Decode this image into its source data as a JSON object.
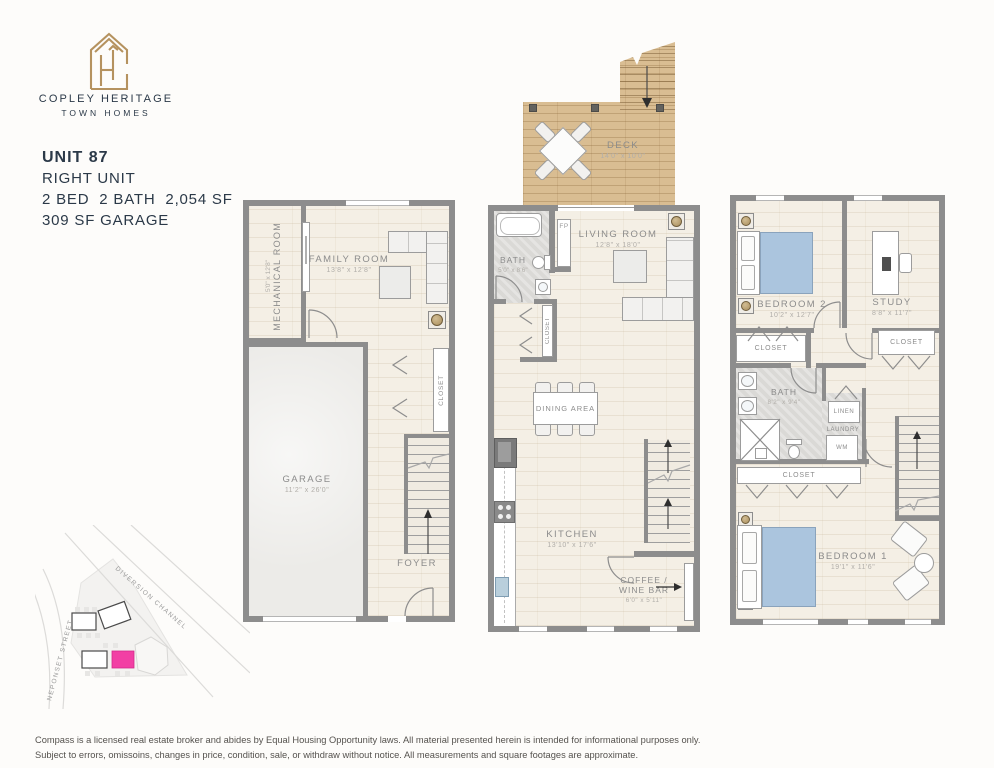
{
  "brand": {
    "line1": "COPLEY HERITAGE",
    "line2": "TOWN HOMES"
  },
  "unit": {
    "title": "UNIT 87",
    "subtitle": "RIGHT UNIT",
    "specs": "2 BED  2 BATH  2,054 SF",
    "garage": "309 SF GARAGE"
  },
  "floor1": {
    "mechanical_name": "MECHANICAL ROOM",
    "mechanical_dims": "5'0\" x 12'8\"",
    "family_name": "FAMILY ROOM",
    "family_dims": "13'8\" x 12'8\"",
    "garage_name": "GARAGE",
    "garage_dims": "11'2\" x 26'0\"",
    "closet": "CLOSET",
    "foyer": "FOYER"
  },
  "floor2": {
    "deck_name": "DECK",
    "deck_dims": "14'0\" x 10'0\"",
    "bath_name": "BATH",
    "bath_dims": "5'0\" x 8'6\"",
    "fireplace": "FP",
    "living_name": "LIVING ROOM",
    "living_dims": "12'8\" x 18'0\"",
    "closet": "CLOSET",
    "dining": "DINING AREA",
    "kitchen_name": "KITCHEN",
    "kitchen_dims": "13'10\" x 17'6\"",
    "coffee_line1": "COFFEE /",
    "coffee_line2": "WINE BAR",
    "coffee_dims": "6'0\" x 5'11\""
  },
  "floor3": {
    "bedroom2_name": "BEDROOM 2",
    "bedroom2_dims": "10'2\" x 12'7\"",
    "study_name": "STUDY",
    "study_dims": "8'8\" x 11'7\"",
    "closet_bedroom2": "CLOSET",
    "closet_study": "CLOSET",
    "bath_name": "BATH",
    "bath_dims": "8'2\" x 9'4\"",
    "linen": "LINEN",
    "laundry": "LAUNDRY",
    "washer": "WM",
    "closet_hall": "CLOSET",
    "bedroom1_name": "BEDROOM 1",
    "bedroom1_dims": "19'1\" x 11'6\""
  },
  "site_map": {
    "road1": "DIVERSION CHANNEL",
    "road2": "NEPONSET STREET",
    "highlight_color": "#f23fa4"
  },
  "disclaimer": {
    "line1": "Compass is a licensed real estate broker and abides by Equal Housing Opportunity laws. All material presented herein is intended for informational purposes only.",
    "line2": "Subject to errors, omissoins, changes in price, condition, sale, or withdraw without notice. All measurements and square footages are approximate."
  },
  "colors": {
    "wall": "#8d8d8d",
    "floor": "#f4efe5",
    "deck": "#d9bd92",
    "accent_gold": "#b5925f",
    "text_navy": "#2b3948",
    "label_gray": "#8c8c8c"
  }
}
